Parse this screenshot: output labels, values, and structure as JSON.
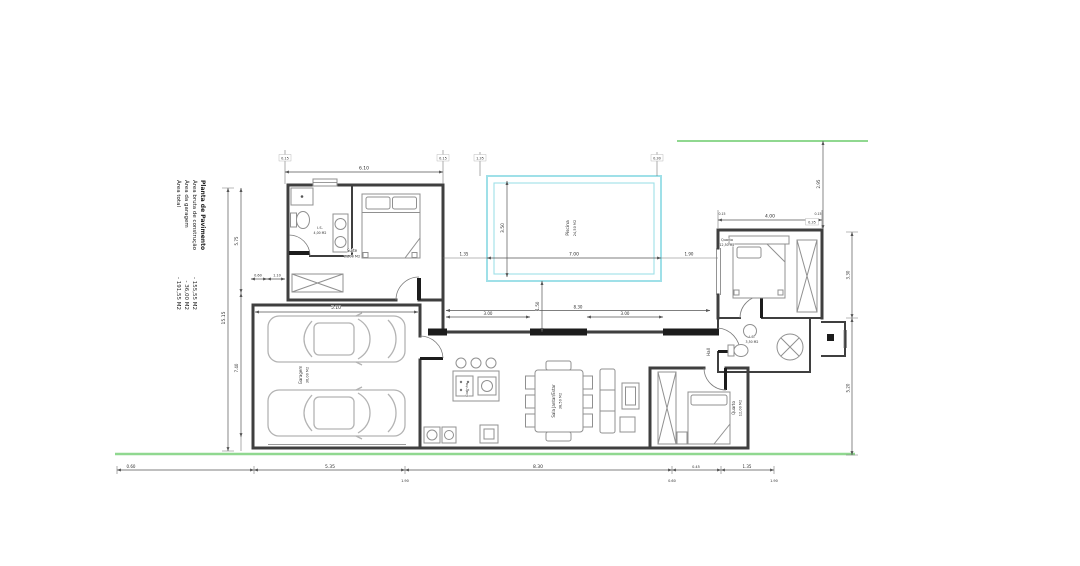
{
  "colors": {
    "wall": "#3f3f3f",
    "furniture": "#909090",
    "dimension": "#555555",
    "pool": "#9fe0e8",
    "boundary": "#90d890",
    "door_fill": "#1c1c1c"
  },
  "legend": {
    "title": "Planta de Pavimento",
    "items": [
      {
        "label": "Área bruta de construção",
        "value": "- 155,55 M2"
      },
      {
        "label": "Área da garagem",
        "value": "- 36,00 M2"
      },
      {
        "label": "Área total",
        "value": "- 191,55 M2"
      }
    ]
  },
  "rooms": {
    "suite": {
      "name": "Suite",
      "area": "16,00 M2"
    },
    "suite_bath": {
      "name": "I.S.",
      "area": "4,00 M2"
    },
    "bedroom1": {
      "name": "Quarto",
      "area": "12,50 M2"
    },
    "bedroom2": {
      "name": "Quarto",
      "area": "12,00 M2"
    },
    "bath2": {
      "name": "I.S.",
      "area": "3,50 M2"
    },
    "hall": {
      "name": "Hall"
    },
    "kitchen": {
      "name": "Cozinha",
      "area": "9,50 M2"
    },
    "dining": {
      "name": "Sala Jantar/Estar",
      "area": "38,50 M2"
    },
    "garage": {
      "name": "Garagem",
      "area": "36,00 M2"
    },
    "pool": {
      "name": "Piscina",
      "area": "24,50 M2"
    }
  },
  "dims": {
    "suite_width": "6.10",
    "garage_width": "5.10",
    "bedroom1_width": "4.00",
    "window1": "3.00",
    "window2": "3.00",
    "windows_total": "8.30",
    "pool_width": "7.00",
    "pool_height": "3.50",
    "pool_offset_left": "1.35",
    "pool_offset_right": "1.90",
    "terrace_depth": "1.50",
    "left_total": "15.15",
    "left_upper": "5.75",
    "left_lower": "7.40",
    "step_a": "0.60",
    "step_b": "1.10",
    "right_upper": "3.30",
    "right_lower": "5.20",
    "right_top": "2.95",
    "right_top_offset": "0.35",
    "bottom_seg1": "0.60",
    "bottom_seg2": "5.35",
    "bottom_seg3": "8.30",
    "bottom_seg4": "0.45",
    "bottom_seg5": "1.35",
    "bottom_sub1": "1.90",
    "bottom_sub2": "0.60",
    "bottom_sub3": "1.90",
    "tick_a": "0.15",
    "tick_b": "0.15",
    "tick_c": "1.35",
    "tick_d": "0.30",
    "wall_tick": "0.15"
  }
}
